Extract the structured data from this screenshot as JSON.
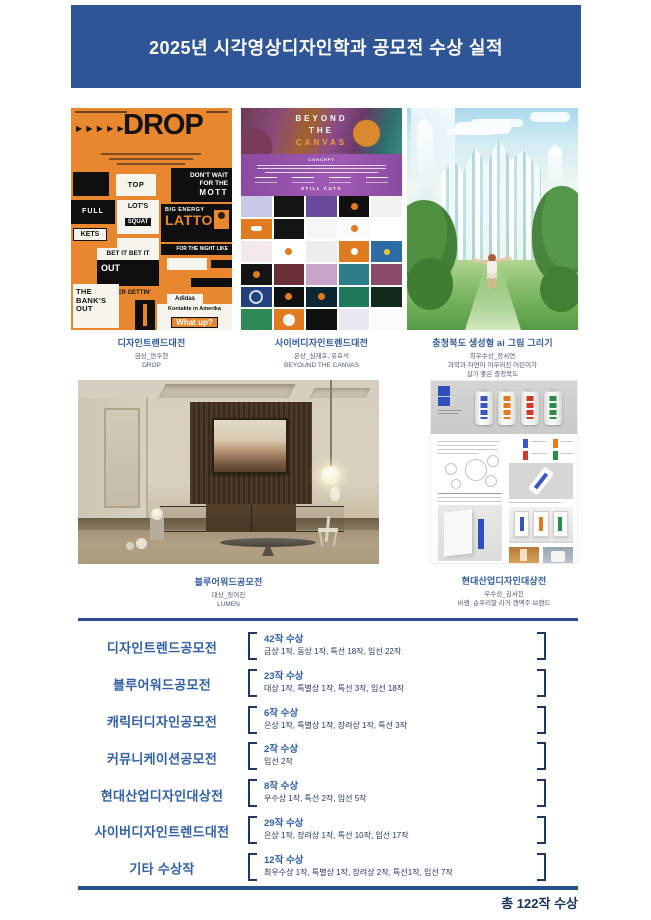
{
  "colors": {
    "primary_blue": "#2e5596",
    "list_blue": "#2e5fa8",
    "navy": "#1f3864",
    "poster_orange": "#e8872e"
  },
  "header": {
    "title": "2025년 시각영상디자인학과 공모전 수상 실적"
  },
  "gallery": {
    "items": [
      {
        "title": "디자인트렌드대전",
        "award": "금상_연수현",
        "work": "DROP"
      },
      {
        "title": "사이버디자인트렌드대전",
        "award": "은상_심재호, 유호석",
        "work": "BEYOUND THE CANVAS"
      },
      {
        "title": "충청북도 생성형 ai 그림 그리기",
        "award": "최우수상_장서연",
        "work": "과학과 자연이 어우러진 어린이가",
        "work2": "살기 좋은 충청북도"
      },
      {
        "title": "블루어워드공모전",
        "award": "대상_정여진",
        "work": "LUMEN"
      },
      {
        "title": "현대산업디자인대상전",
        "award": "우수상_김서진",
        "work": "바램: 순우리말 라거 캔맥주 브랜드"
      }
    ]
  },
  "posters": {
    "drop": {
      "arrows": "▶ ▶ ▶ ▶ ▶",
      "title": "DROP",
      "top": "TOP",
      "dont_wait": "DON'T WAIT FOR THE",
      "mott": "MOTT",
      "full": "FULL",
      "lots": "LOT'S",
      "squat": "SQUAT",
      "big_energy": "BIG ENERGY",
      "latto": "LATTO",
      "night": "FOR THE NIGHT LIKE",
      "kets": "KETS",
      "seinfeld": "SEINFELD",
      "bet_it": "BET IT BET IT",
      "out": "OUT",
      "never": "NEVER GETTIN'",
      "banks": "THE BANK'S OUT",
      "adidas": "Adidas",
      "kontakte": "Kontakte in Amerika",
      "what_up": "What up?",
      "ich_frage": "ich frage sie"
    },
    "canvas": {
      "line1": "BEYOND",
      "line2": "THE",
      "line3": "CANVAS",
      "concept": "CONCEPT",
      "still_cuts": "STILL CUTS"
    }
  },
  "awards": {
    "rows": [
      {
        "competition": "디자인트렌드공모전",
        "count": "42작 수상",
        "detail": "금상 1작, 동상 1작, 특선 18작, 입선 22작"
      },
      {
        "competition": "블루어워드공모전",
        "count": "23작 수상",
        "detail": "대상 1작, 특별상 1작, 특선 3작, 입선 18작"
      },
      {
        "competition": "캐릭터디자인공모전",
        "count": "6작 수상",
        "detail": "은상 1작, 특별상 1작, 장려상 1작, 특선 3작"
      },
      {
        "competition": "커뮤니케이션공모전",
        "count": "2작 수상",
        "detail": "입선 2작"
      },
      {
        "competition": "현대산업디자인대상전",
        "count": "8작 수상",
        "detail": "우수상 1작, 특선 2작, 입선 5작"
      },
      {
        "competition": "사이버디자인트렌드대전",
        "count": "29작 수상",
        "detail": "은상 1작, 장려상 1작, 특선 10작, 입선 17작"
      },
      {
        "competition": "기타 수상작",
        "count": "12작 수상",
        "detail": "최우수상 1작, 특별상 1작, 장려상 2작, 특선1작, 입선 7작"
      }
    ],
    "total": "총 122작 수상"
  }
}
